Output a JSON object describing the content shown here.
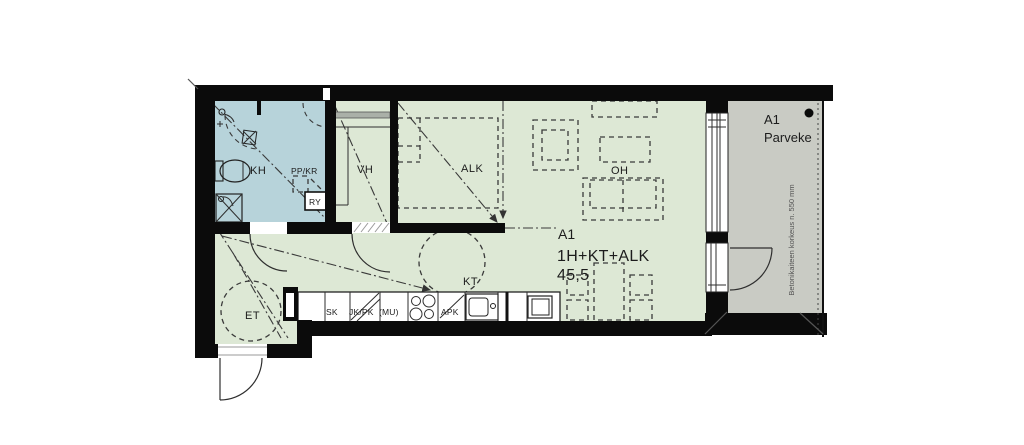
{
  "apartment": {
    "id": "A1",
    "type": "1H+KT+ALK",
    "area": "45,5"
  },
  "rooms": {
    "bathroom": "KH",
    "walkin_closet": "VH",
    "sleeping_alcove": "ALK",
    "living_room": "OH",
    "kitchenette": "KT",
    "entry": "ET"
  },
  "kitchen_units": {
    "cabinet": "SK",
    "fridge_freezer": "JK/PK",
    "microwave": "(MU)",
    "dishwasher": "APK"
  },
  "bathroom_units": {
    "laundry_reservation": "PP/KR",
    "distribution_board": "RY"
  },
  "balcony": {
    "id": "A1",
    "label": "Parveke",
    "railing_note": "Betonikaiteen korkeus n. 550 mm"
  },
  "colors": {
    "wall": "#0b0b0b",
    "floor": "#dde8d5",
    "bathroom": "#b7d3da",
    "balcony": "#c9cbc4"
  }
}
